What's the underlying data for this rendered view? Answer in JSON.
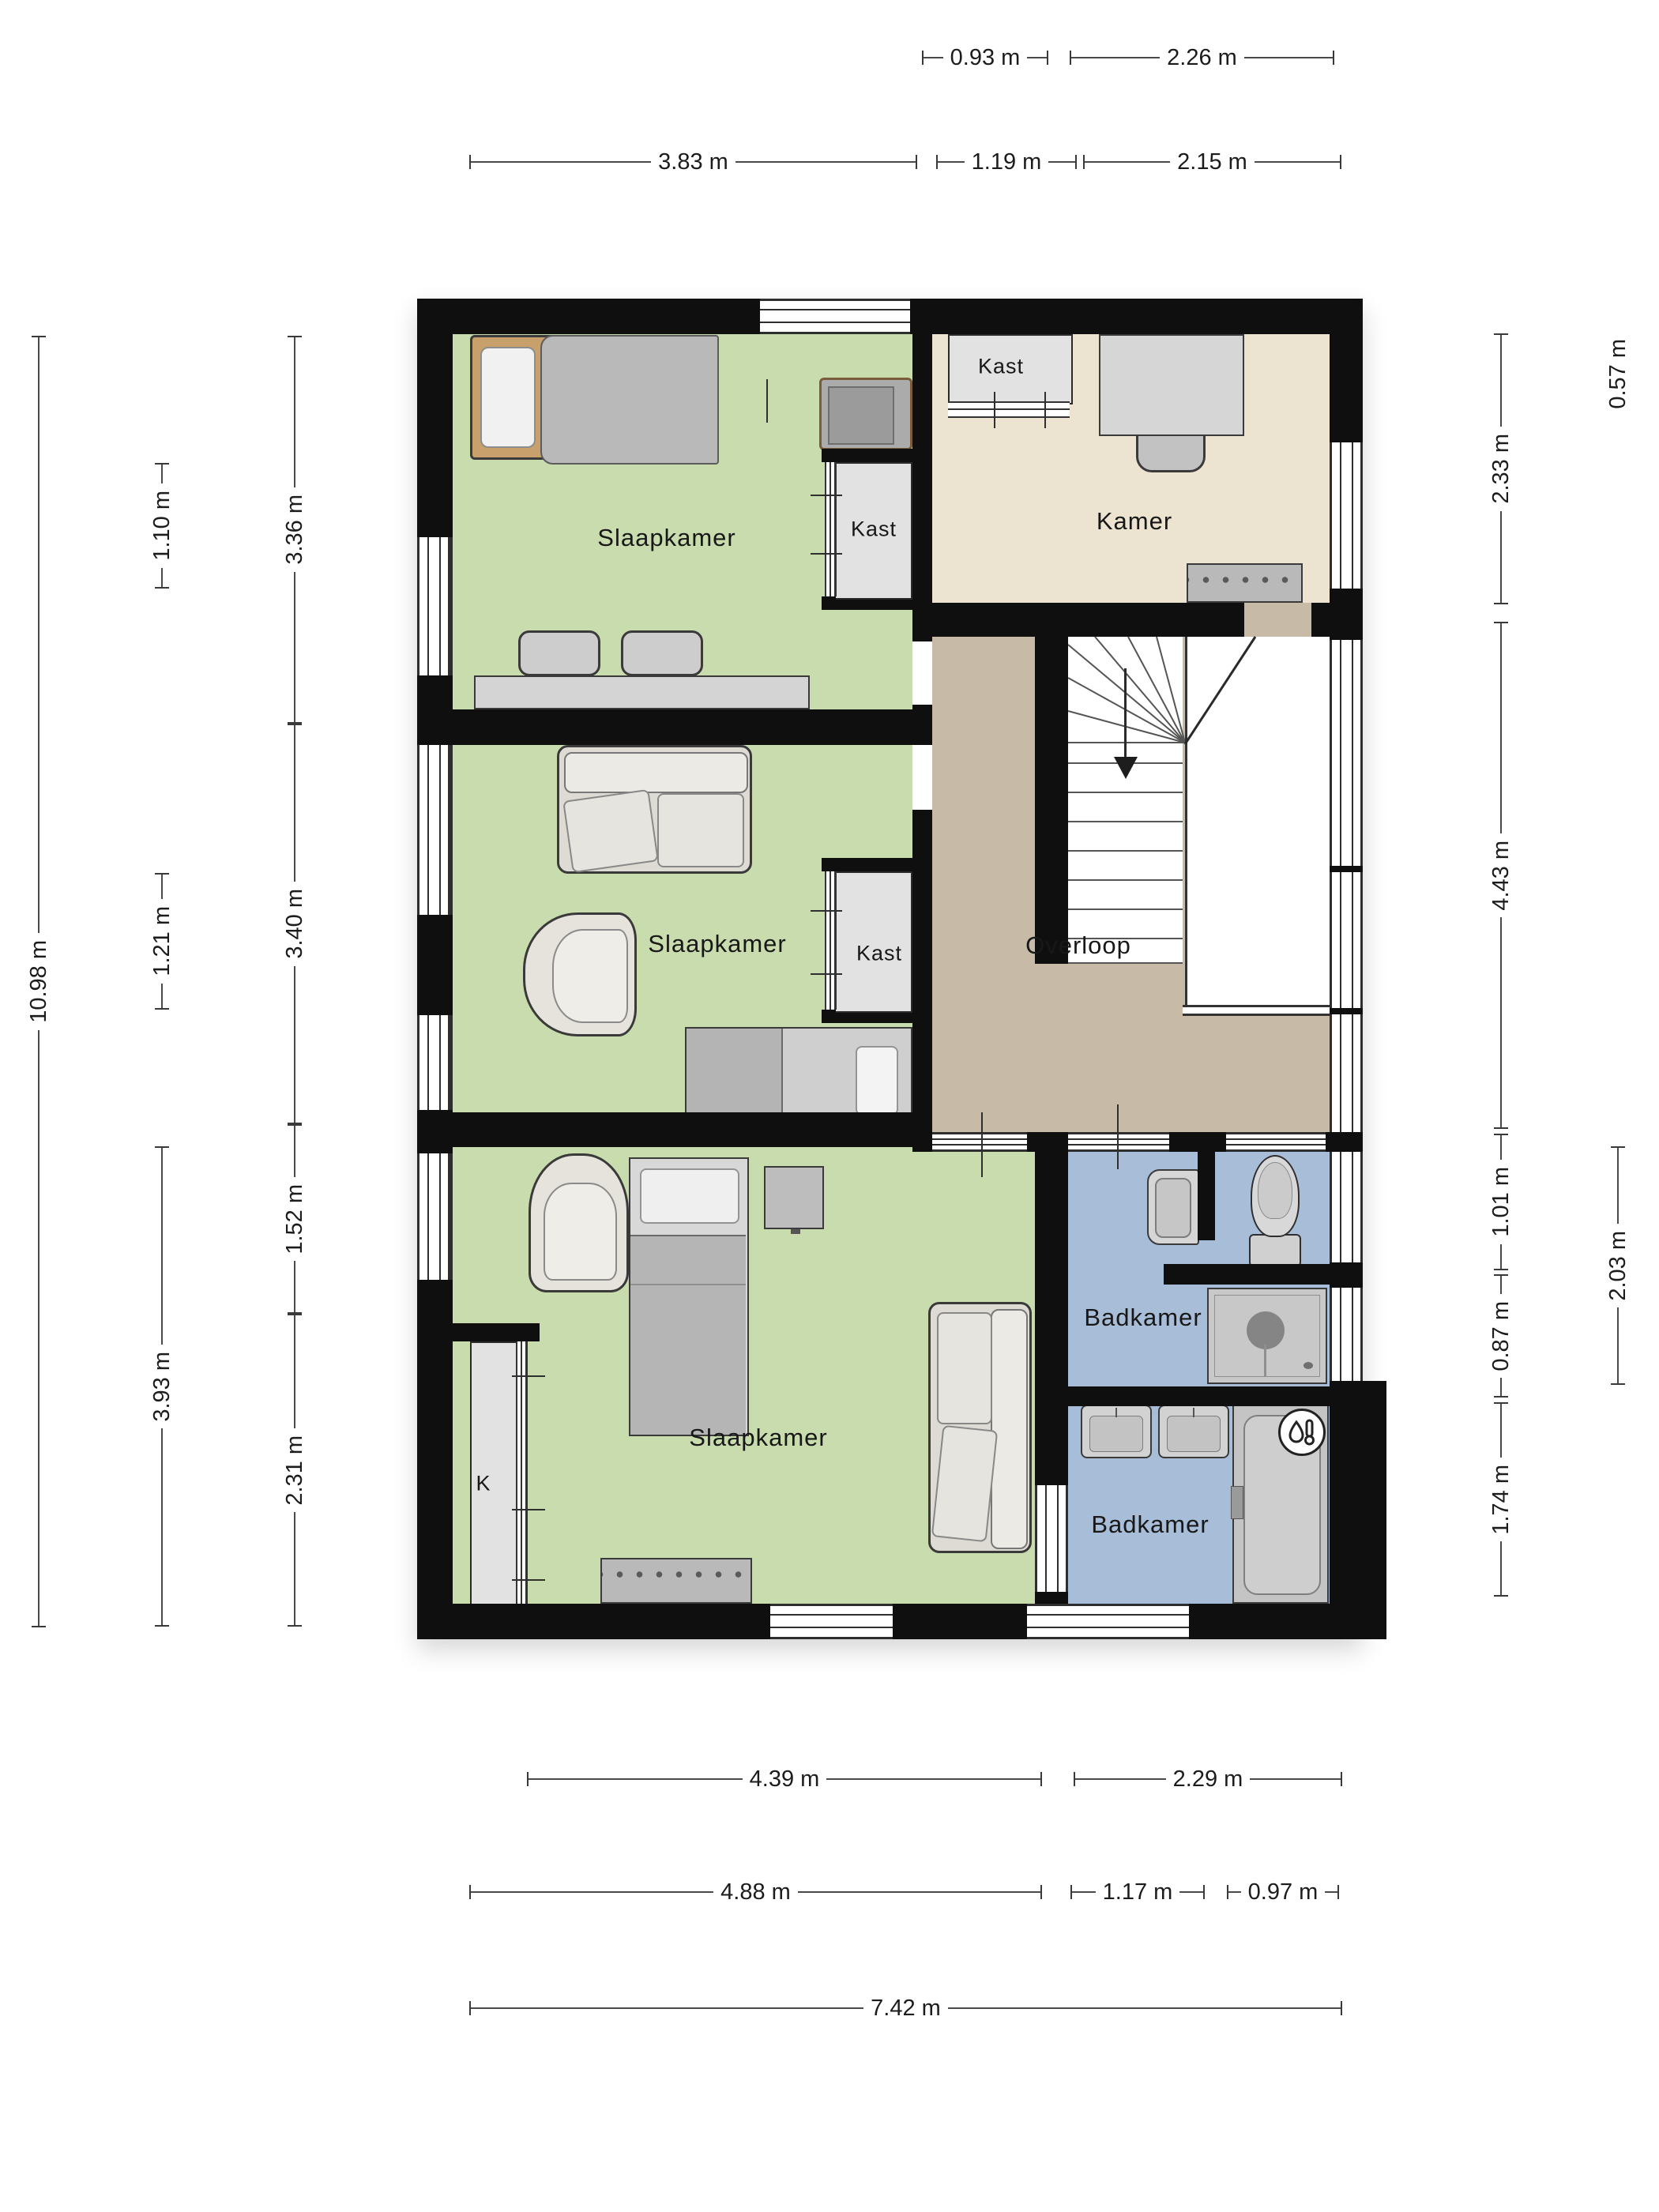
{
  "rooms": {
    "bedroom_top": "Slaapkamer",
    "bedroom_top_closet": "Kast",
    "kamer": "Kamer",
    "kamer_closet": "Kast",
    "bedroom_middle": "Slaapkamer",
    "bedroom_middle_closet": "Kast",
    "overloop": "Overloop",
    "bathroom_top": "Badkamer",
    "bathroom_bottom": "Badkamer",
    "bedroom_bottom": "Slaapkamer",
    "bedroom_bottom_closet": "K"
  },
  "dimensions": {
    "top": [
      "0.93 m",
      "2.26 m",
      "3.83 m",
      "1.19 m",
      "2.15 m"
    ],
    "bottom": [
      "4.39 m",
      "2.29 m",
      "4.88 m",
      "1.17 m",
      "0.97 m",
      "7.42 m"
    ],
    "left": [
      "10.98 m",
      "1.10 m",
      "1.21 m",
      "3.93 m",
      "3.36 m",
      "3.40 m",
      "1.52 m",
      "2.31 m"
    ],
    "right": [
      "2.33 m",
      "4.43 m",
      "1.01 m",
      "0.87 m",
      "1.74 m",
      "0.57 m",
      "2.03 m"
    ]
  },
  "colors": {
    "wall": "#0f0f0f",
    "bedroom_fill": "#c9dcae",
    "kamer_fill": "#ece4d0",
    "hallway_fill": "#c7bba7",
    "bathroom_fill": "#a7bdd8",
    "closet_fill": "#e2e2e2"
  }
}
